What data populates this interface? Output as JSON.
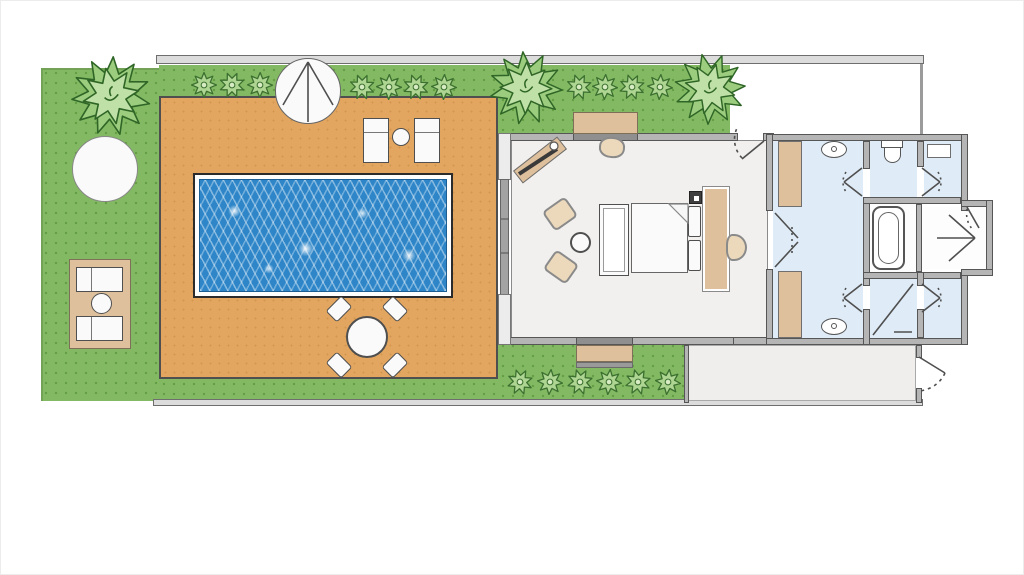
{
  "description": "Architectural floor plan (no text labels): walled garden with lawn, pool deck, swimming pool, sun loungers, dining set, parasol and planting; bedroom pavilion with bed, bench, armchairs, console and desk; bathroom wing with twin vanities, toilet room, bathtub nook, two showers, wardrobes; entry walkway and rear corridor.",
  "rooms": [
    "garden-lawn",
    "pool-deck",
    "swimming-pool",
    "bedroom",
    "bathroom",
    "toilet-room",
    "bathtub-nook",
    "shower-room",
    "entry-vestibule",
    "entry-walkway",
    "rear-corridor"
  ],
  "colors": {
    "grass": "#82b962",
    "grass_dot": "#639e45",
    "deck": "#e2a660",
    "pool_water": "#2e86c8",
    "boundary_bar": "#dcdcdc",
    "wall_fill": "#b5b5b5",
    "wall_line": "#565656",
    "bedroom_floor": "#f1f0ee",
    "bathroom_floor": "#dfecf7",
    "corridor_floor": "#efeeec",
    "wood": "#dfc09c",
    "furniture_white": "#fafafa",
    "furniture_edge": "#4f4f4f",
    "plant_fill": "#9ccd7e",
    "plant_fill_light": "#bfe0a6",
    "plant_line": "#2f6627",
    "bush_fill": "#aed592",
    "bush_center": "#d8ecc4",
    "bush_line": "#3c7030"
  },
  "garden": {
    "big_plants": [
      {
        "x": 110,
        "y": 95,
        "r": 40
      },
      {
        "x": 525,
        "y": 87,
        "r": 37
      },
      {
        "x": 709,
        "y": 88,
        "r": 36
      }
    ],
    "top_bushes": [
      {
        "x": 203,
        "y": 84
      },
      {
        "x": 231,
        "y": 84
      },
      {
        "x": 259,
        "y": 84
      },
      {
        "x": 361,
        "y": 86
      },
      {
        "x": 388,
        "y": 86
      },
      {
        "x": 415,
        "y": 86
      },
      {
        "x": 443,
        "y": 86
      },
      {
        "x": 578,
        "y": 86
      },
      {
        "x": 604,
        "y": 86
      },
      {
        "x": 631,
        "y": 86
      },
      {
        "x": 659,
        "y": 86
      }
    ],
    "bottom_bushes": [
      {
        "x": 519,
        "y": 381
      },
      {
        "x": 549,
        "y": 381
      },
      {
        "x": 579,
        "y": 381
      },
      {
        "x": 608,
        "y": 381
      },
      {
        "x": 637,
        "y": 381
      },
      {
        "x": 667,
        "y": 381
      }
    ],
    "bush_size": 26
  },
  "dining_set": {
    "table_center": {
      "x": 366,
      "y": 336
    },
    "table_radius": 21,
    "chairs": [
      {
        "dx": -28,
        "dy": -28,
        "rot": -45
      },
      {
        "dx": 28,
        "dy": -28,
        "rot": 45
      },
      {
        "dx": -28,
        "dy": 28,
        "rot": 45
      },
      {
        "dx": 28,
        "dy": 28,
        "rot": -45
      }
    ]
  },
  "counts": {
    "sun_loungers": 4,
    "armchairs": 2,
    "sinks": 2,
    "showers": 2,
    "wardrobes": 2
  }
}
